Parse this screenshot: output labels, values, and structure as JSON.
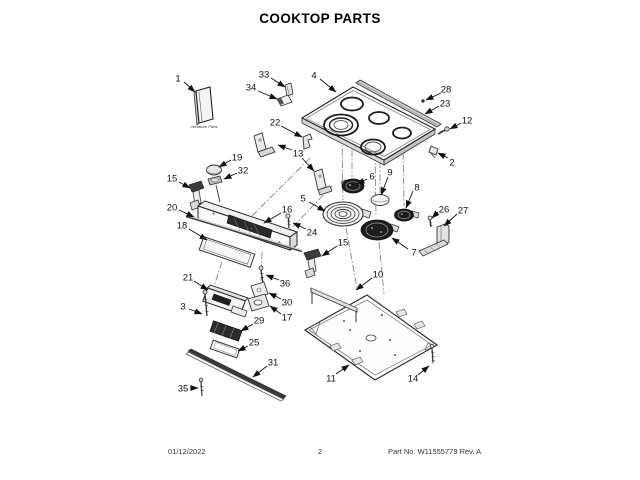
{
  "page": {
    "title": "COOKTOP PARTS",
    "footer": {
      "date": "01/12/2022",
      "page_number": "2",
      "part_no": "Part No. W11555779  Rev. A"
    }
  },
  "diagram": {
    "literature_label": "Literature Parts",
    "callouts": [
      {
        "label": "1",
        "tx": 178,
        "ty": 78,
        "arrows": [
          [
            184,
            82,
            195,
            92
          ]
        ]
      },
      {
        "label": "33",
        "tx": 264,
        "ty": 74,
        "arrows": [
          [
            271,
            78,
            285,
            87
          ]
        ]
      },
      {
        "label": "34",
        "tx": 251,
        "ty": 87,
        "arrows": [
          [
            258,
            91,
            277,
            99
          ]
        ]
      },
      {
        "label": "4",
        "tx": 314,
        "ty": 75,
        "arrows": [
          [
            320,
            79,
            336,
            92
          ]
        ]
      },
      {
        "label": "28",
        "tx": 446,
        "ty": 89,
        "arrows": [
          [
            441,
            93,
            426,
            100
          ]
        ]
      },
      {
        "label": "23",
        "tx": 445,
        "ty": 103,
        "arrows": [
          [
            439,
            106,
            425,
            114
          ]
        ]
      },
      {
        "label": "12",
        "tx": 467,
        "ty": 120,
        "arrows": [
          [
            461,
            123,
            450,
            129
          ]
        ]
      },
      {
        "label": "2",
        "tx": 452,
        "ty": 162,
        "arrows": [
          [
            448,
            158,
            438,
            153
          ]
        ]
      },
      {
        "label": "19",
        "tx": 237,
        "ty": 157,
        "arrows": [
          [
            231,
            160,
            219,
            167
          ]
        ]
      },
      {
        "label": "32",
        "tx": 243,
        "ty": 170,
        "arrows": [
          [
            237,
            173,
            224,
            179
          ]
        ]
      },
      {
        "label": "22",
        "tx": 275,
        "ty": 122,
        "arrows": [
          [
            281,
            126,
            302,
            137
          ]
        ]
      },
      {
        "label": "13",
        "tx": 298,
        "ty": 153,
        "arrows": [
          [
            292,
            150,
            278,
            145
          ],
          [
            302,
            158,
            314,
            171
          ]
        ]
      },
      {
        "label": "5",
        "tx": 303,
        "ty": 198,
        "arrows": [
          [
            309,
            202,
            325,
            211
          ]
        ]
      },
      {
        "label": "6",
        "tx": 372,
        "ty": 176,
        "arrows": [
          [
            367,
            179,
            357,
            184
          ]
        ]
      },
      {
        "label": "9",
        "tx": 390,
        "ty": 172,
        "arrows": [
          [
            388,
            177,
            381,
            195
          ]
        ]
      },
      {
        "label": "8",
        "tx": 417,
        "ty": 187,
        "arrows": [
          [
            413,
            191,
            406,
            208
          ]
        ]
      },
      {
        "label": "26",
        "tx": 444,
        "ty": 209,
        "arrows": [
          [
            438,
            212,
            432,
            218
          ]
        ]
      },
      {
        "label": "27",
        "tx": 463,
        "ty": 210,
        "arrows": [
          [
            457,
            214,
            444,
            226
          ]
        ]
      },
      {
        "label": "7",
        "tx": 414,
        "ty": 252,
        "arrows": [
          [
            408,
            249,
            392,
            238
          ]
        ]
      },
      {
        "label": "15",
        "tx": 172,
        "ty": 178,
        "arrows": [
          [
            179,
            182,
            190,
            188
          ]
        ]
      },
      {
        "label": "20",
        "tx": 172,
        "ty": 207,
        "arrows": [
          [
            179,
            210,
            194,
            217
          ]
        ]
      },
      {
        "label": "18",
        "tx": 182,
        "ty": 225,
        "arrows": [
          [
            189,
            229,
            207,
            240
          ]
        ]
      },
      {
        "label": "16",
        "tx": 287,
        "ty": 209,
        "arrows": [
          [
            281,
            213,
            264,
            223
          ]
        ]
      },
      {
        "label": "24",
        "tx": 312,
        "ty": 232,
        "arrows": [
          [
            306,
            229,
            293,
            223
          ]
        ]
      },
      {
        "label": "15",
        "tx": 343,
        "ty": 242,
        "arrows": [
          [
            337,
            246,
            322,
            256
          ]
        ]
      },
      {
        "label": "36",
        "tx": 285,
        "ty": 283,
        "arrows": [
          [
            279,
            280,
            266,
            275
          ]
        ]
      },
      {
        "label": "30",
        "tx": 287,
        "ty": 302,
        "arrows": [
          [
            281,
            299,
            269,
            293
          ]
        ]
      },
      {
        "label": "17",
        "tx": 287,
        "ty": 317,
        "arrows": [
          [
            281,
            314,
            270,
            306
          ]
        ]
      },
      {
        "label": "21",
        "tx": 188,
        "ty": 277,
        "arrows": [
          [
            194,
            281,
            208,
            290
          ]
        ]
      },
      {
        "label": "3",
        "tx": 183,
        "ty": 306,
        "arrows": [
          [
            189,
            309,
            202,
            314
          ]
        ]
      },
      {
        "label": "29",
        "tx": 259,
        "ty": 320,
        "arrows": [
          [
            253,
            324,
            241,
            331
          ]
        ]
      },
      {
        "label": "25",
        "tx": 254,
        "ty": 342,
        "arrows": [
          [
            248,
            346,
            238,
            351
          ]
        ]
      },
      {
        "label": "31",
        "tx": 273,
        "ty": 362,
        "arrows": [
          [
            267,
            366,
            253,
            377
          ]
        ]
      },
      {
        "label": "35",
        "tx": 183,
        "ty": 388,
        "arrows": [
          [
            190,
            388,
            198,
            388
          ]
        ]
      },
      {
        "label": "10",
        "tx": 378,
        "ty": 274,
        "arrows": [
          [
            372,
            278,
            356,
            290
          ]
        ]
      },
      {
        "label": "11",
        "tx": 331,
        "ty": 378,
        "arrows": [
          [
            336,
            374,
            349,
            365
          ]
        ]
      },
      {
        "label": "14",
        "tx": 413,
        "ty": 378,
        "arrows": [
          [
            418,
            375,
            429,
            366
          ]
        ]
      }
    ]
  }
}
